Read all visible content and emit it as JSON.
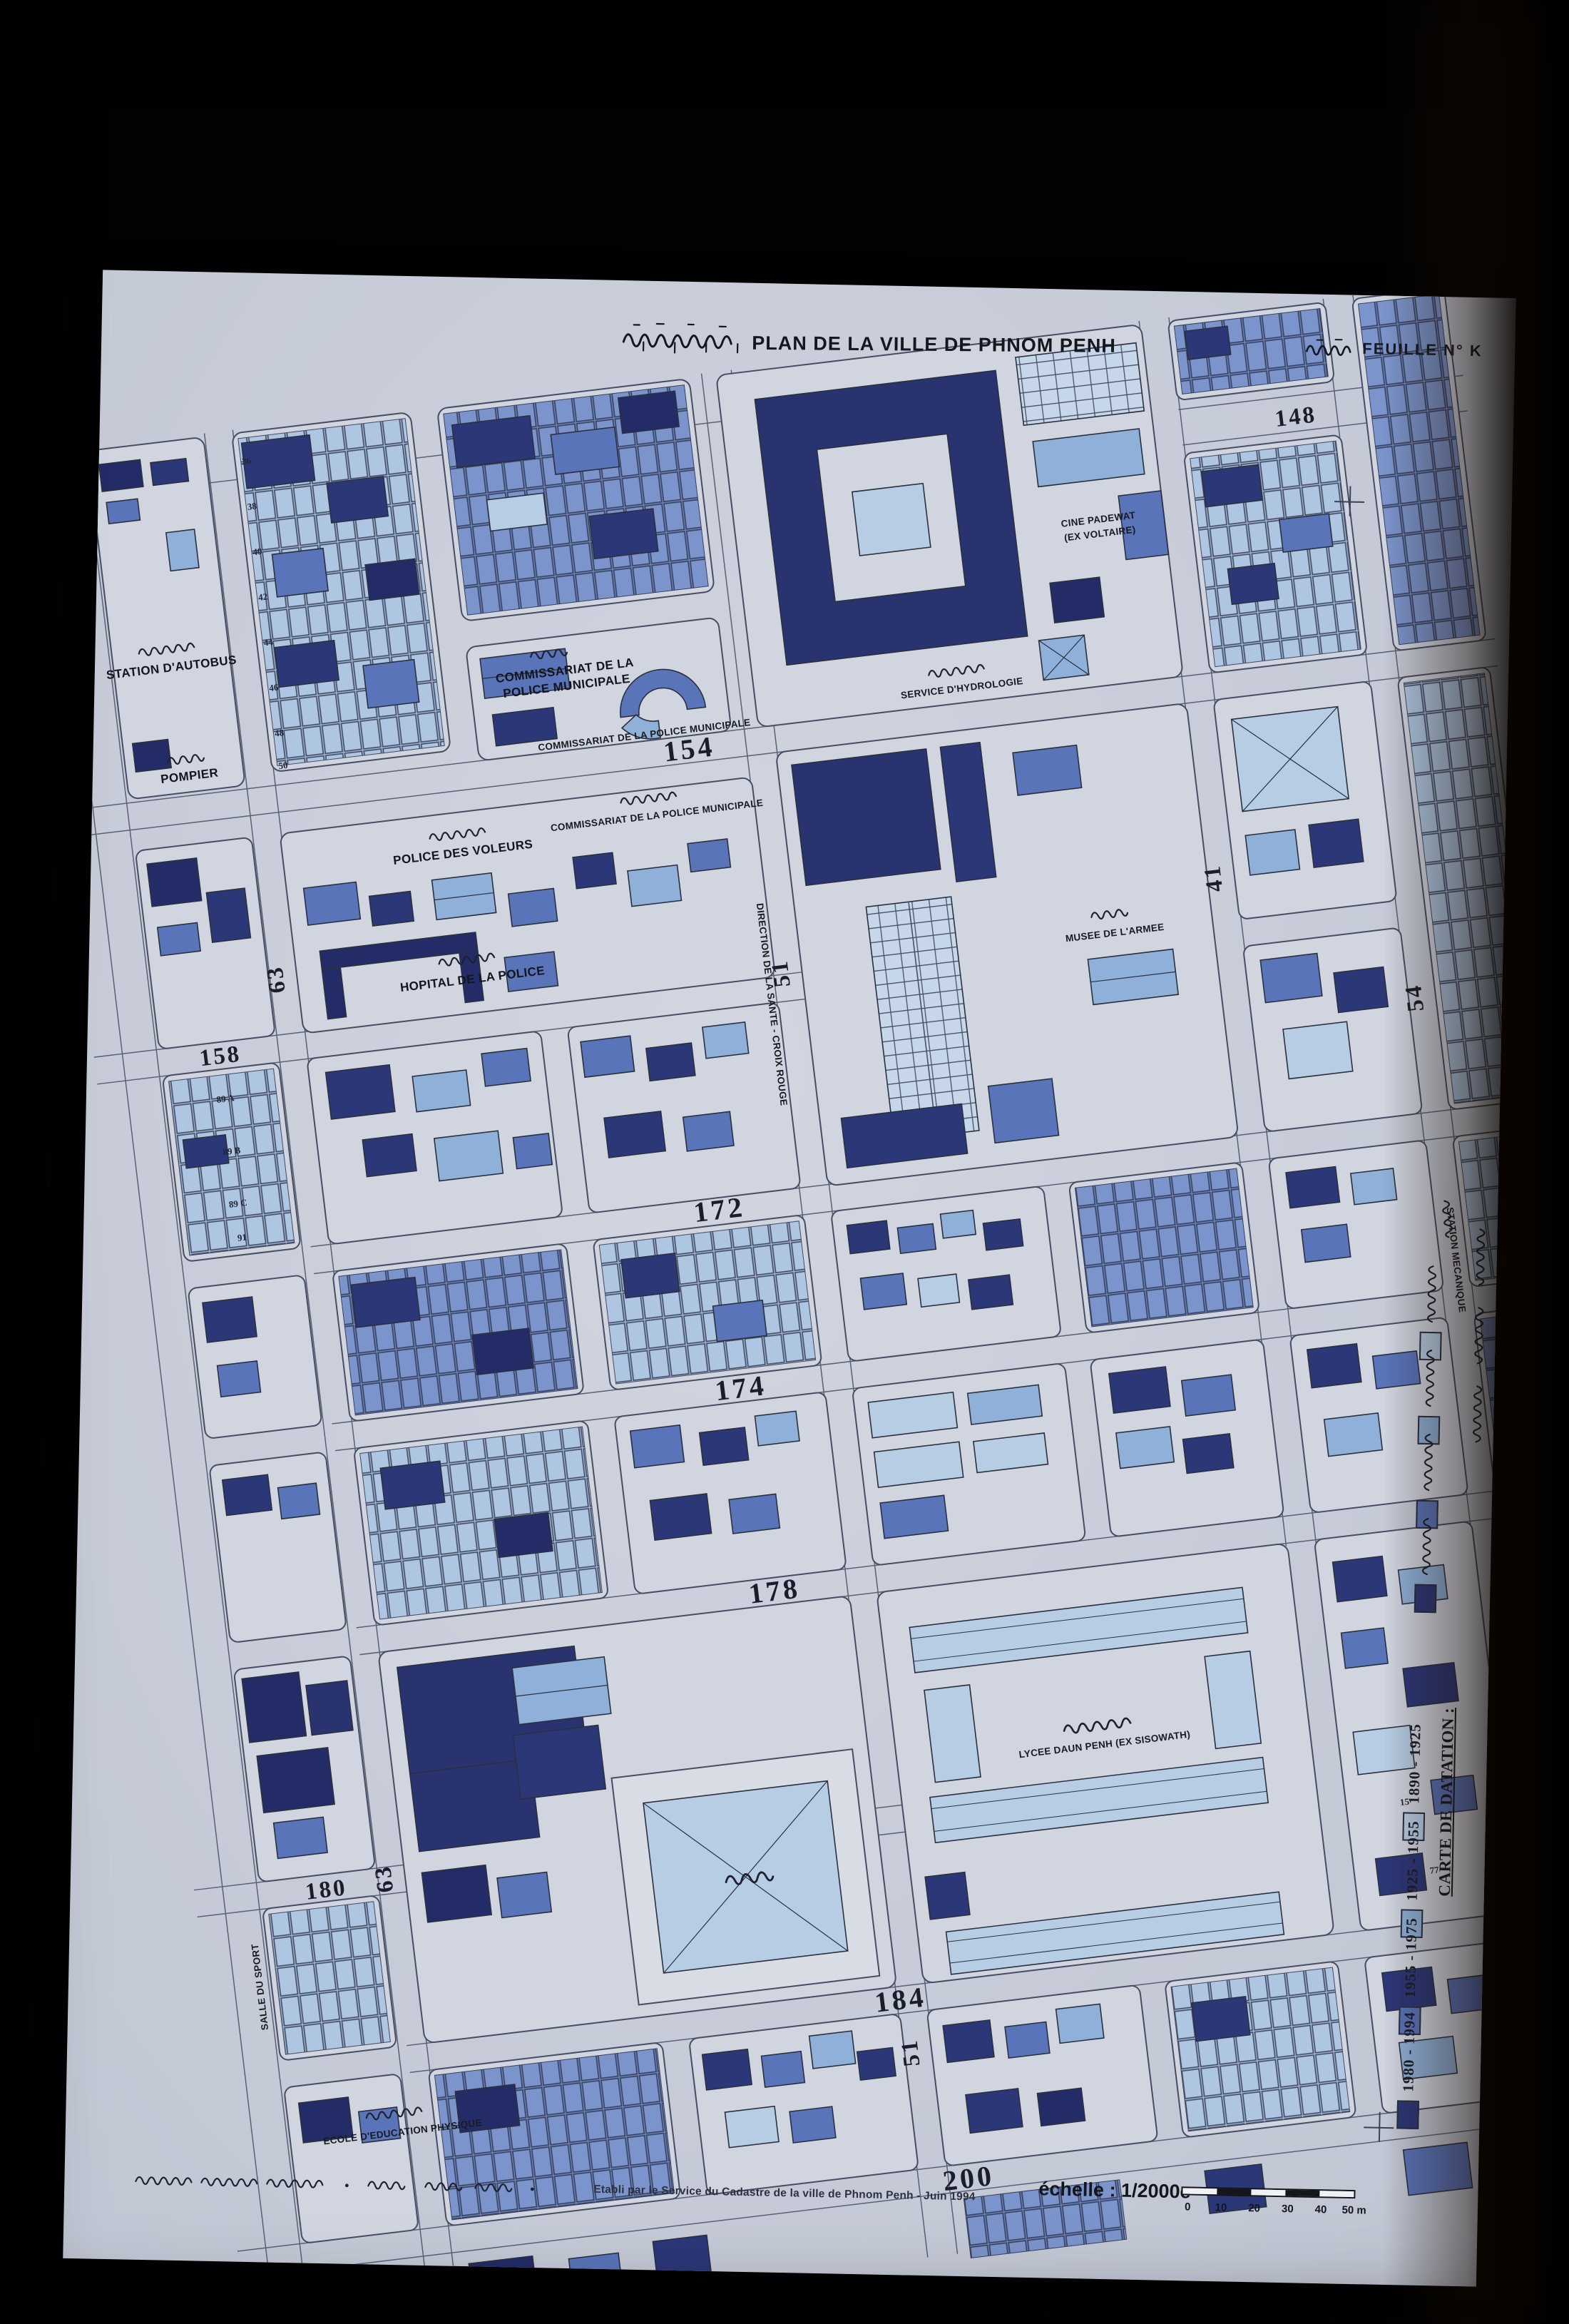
{
  "header": {
    "title_khmer": "ទីក្រុងភ្នំពេញ",
    "title_fr": "PLAN DE LA VILLE DE PHNOM PENH",
    "sheet_khmer": "ទំព័រ",
    "sheet_label": "FEUILLE N° K"
  },
  "legend": {
    "title_fr": "CARTE DE DATATION :",
    "title_khmer_present": true,
    "entries": [
      {
        "period": "1890 - 1925",
        "period_khmer": "១៨៩០-១៩២៥",
        "color": "#b7cde4"
      },
      {
        "period": "1925 - 1955",
        "period_khmer": "១៩២៥-១៩៥៥",
        "color": "#8fb0d8"
      },
      {
        "period": "1955 - 1975",
        "period_khmer": "១៩៥៥-១៩៧៥",
        "color": "#5a74ba"
      },
      {
        "period": "1980 - 1994",
        "period_khmer": "១៩៨០-១៩៩៤",
        "color": "#2c3778"
      }
    ]
  },
  "streets": [
    "148",
    "154",
    "158",
    "63",
    "172",
    "174",
    "178",
    "180",
    "184",
    "200",
    "51",
    "41",
    "54",
    "63",
    "51"
  ],
  "pois": [
    {
      "id": "station-autobus",
      "label": "STATION D'AUTOBUS"
    },
    {
      "id": "pompier",
      "label": "POMPIER"
    },
    {
      "id": "commissariat-a-1",
      "label": "COMMISSARIAT DE LA"
    },
    {
      "id": "commissariat-a-2",
      "label": "POLICE MUNICIPALE"
    },
    {
      "id": "commissariat-b",
      "label": "COMMISSARIAT DE LA POLICE MUNICIPALE"
    },
    {
      "id": "police-voleurs",
      "label": "POLICE DES VOLEURS"
    },
    {
      "id": "commissariat-c",
      "label": "COMMISSARIAT DE LA POLICE MUNICIPALE"
    },
    {
      "id": "hopital-police",
      "label": "HOPITAL DE LA POLICE"
    },
    {
      "id": "direction-sante",
      "label": "DIRECTION DE LA SANTE - CROIX ROUGE"
    },
    {
      "id": "musee-armee",
      "label": "MUSEE DE L'ARMEE"
    },
    {
      "id": "service-hydrologie",
      "label": "SERVICE D'HYDROLOGIE"
    },
    {
      "id": "cine-padewat",
      "label": "CINE PADEWAT"
    },
    {
      "id": "cine-padewat-2",
      "label": "(EX VOLTAIRE)"
    },
    {
      "id": "lycee-daun-penh",
      "label": "LYCEE DAUN PENH (EX SISOWATH)"
    },
    {
      "id": "ecole-education-physique",
      "label": "ECOLE D'EDUCATION PHYSIQUE"
    },
    {
      "id": "salle-du-sport",
      "label": "SALLE DU SPORT"
    },
    {
      "id": "station-mecanique",
      "label": "STATION MECANIQUE"
    }
  ],
  "parcels": [
    "36",
    "38",
    "40",
    "42",
    "44",
    "46",
    "48",
    "50",
    "89 A",
    "89 B",
    "89 C",
    "91",
    "15",
    "77"
  ],
  "footer": {
    "credit": "Etabli par le Service du Cadastre de la ville de Phnom Penh - Juin 1994",
    "scale_label": "échelle : 1/2000e",
    "scale_ticks": [
      "0",
      "10",
      "20",
      "30",
      "40",
      "50 m"
    ]
  }
}
